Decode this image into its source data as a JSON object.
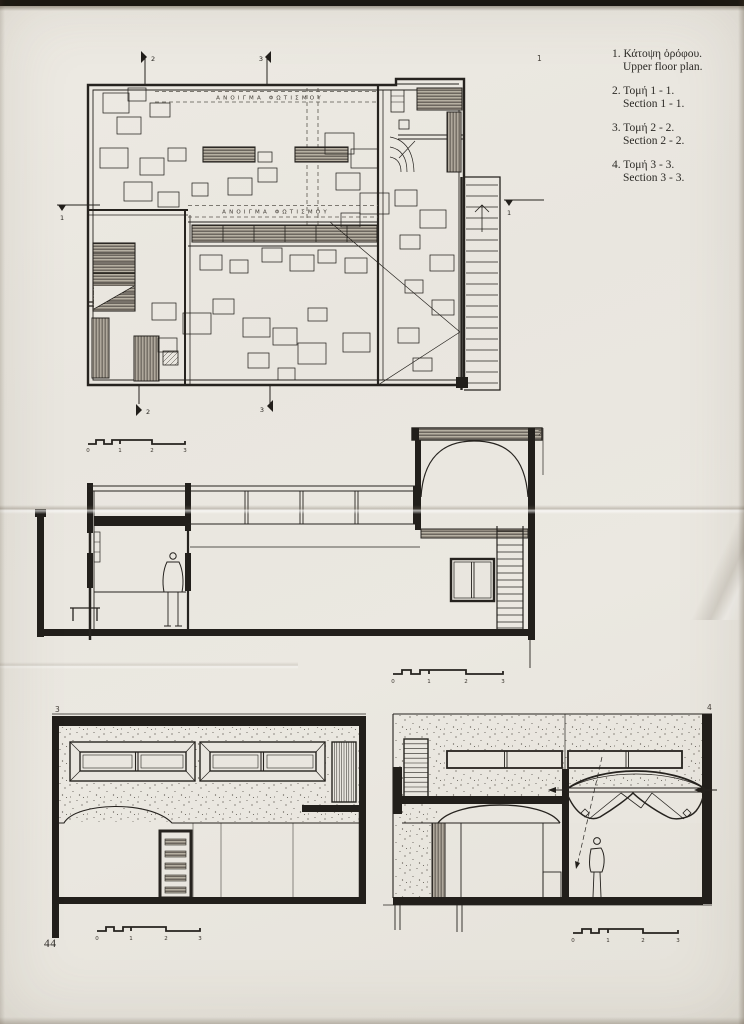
{
  "page": {
    "number": "44"
  },
  "legend": {
    "items": [
      {
        "num": "1.",
        "greek": "Κάτοψη ὀρόφου.",
        "english": "Upper floor plan."
      },
      {
        "num": "2.",
        "greek": "Τομή 1 - 1.",
        "english": "Section 1 - 1."
      },
      {
        "num": "3.",
        "greek": "Τομή 2 - 2.",
        "english": "Section 2 - 2."
      },
      {
        "num": "4.",
        "greek": "Τομή 3 - 3.",
        "english": "Section 3 - 3."
      }
    ]
  },
  "plan": {
    "number": "1",
    "skylight_label": "ΑΝΟΙΓΜΑ ΦΩΤΙΣΜΟΥ",
    "markers": {
      "top_2": "2",
      "top_3": "3",
      "bottom_2": "2",
      "bottom_3": "3",
      "left_1": "1",
      "right_1": "1"
    }
  },
  "sections": {
    "section_1_1": {
      "number": "2"
    },
    "section_2_2": {
      "number": "3"
    },
    "section_3_3": {
      "number": "4"
    }
  },
  "scale_bar": {
    "ticks": [
      "0",
      "1",
      "2",
      "3"
    ]
  },
  "colors": {
    "paper": "#e9e6df",
    "ink": "#26231f"
  }
}
